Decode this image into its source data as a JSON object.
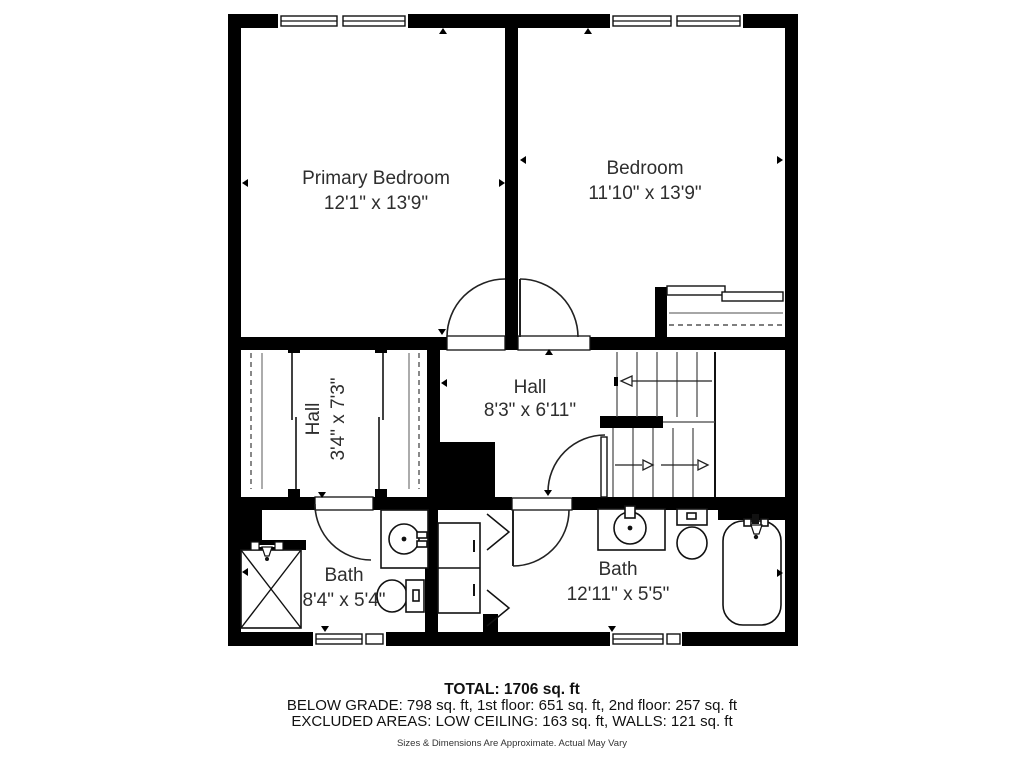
{
  "meta": {
    "type": "floor-plan"
  },
  "colors": {
    "wall": "#000000",
    "floor": "#ffffff",
    "fixture_line": "#1a1a1a",
    "label_text": "#2e2e2e"
  },
  "rooms": [
    {
      "name": "Primary Bedroom",
      "dimensions": "12'1\" x 13'9\""
    },
    {
      "name": "Bedroom",
      "dimensions": "11'10\" x 13'9\""
    },
    {
      "name": "Hall",
      "dimensions": "3'4\" x 7'3\"",
      "orientation": "vertical"
    },
    {
      "name": "Hall",
      "dimensions": "8'3\" x 6'11\""
    },
    {
      "name": "Bath",
      "dimensions": "8'4\" x 5'4\""
    },
    {
      "name": "Bath",
      "dimensions": "12'11\" x 5'5\""
    }
  ],
  "fixtures": [
    "shower",
    "sink",
    "toilet",
    "bathtub",
    "linen-cabinet",
    "bifold-doors",
    "closet-rods",
    "stairs"
  ],
  "footer": {
    "total": "TOTAL: 1706 sq. ft",
    "area_breakdown": "BELOW GRADE: 798 sq. ft, 1st floor: 651 sq. ft, 2nd floor: 257 sq. ft",
    "excluded_areas": "EXCLUDED AREAS: LOW CEILING: 163 sq. ft, WALLS: 121 sq. ft",
    "disclaimer": "Sizes & Dimensions Are Approximate. Actual May Vary"
  }
}
